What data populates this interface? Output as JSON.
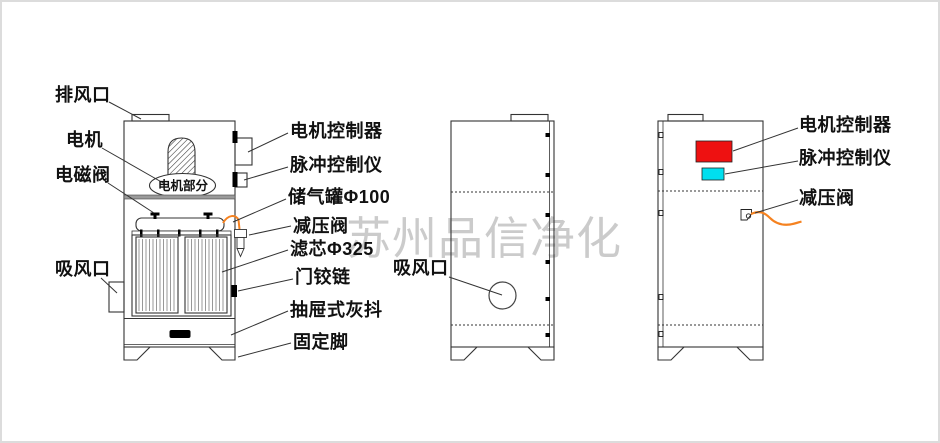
{
  "watermark": {
    "text": "苏州品信净化"
  },
  "colors": {
    "controller_red": "#ee1111",
    "pulse_cyan": "#00dfef",
    "tube_orange": "#f58220"
  },
  "front_view": {
    "motor_section_label": "电机部分",
    "labels_left": [
      {
        "id": "exhaust-outlet",
        "text": "排风口"
      },
      {
        "id": "motor",
        "text": "电机"
      },
      {
        "id": "solenoid-valve",
        "text": "电磁阀"
      },
      {
        "id": "suction-inlet",
        "text": "吸风口"
      }
    ],
    "labels_right": [
      {
        "id": "motor-controller",
        "text": "电机控制器"
      },
      {
        "id": "pulse-controller",
        "text": "脉冲控制仪"
      },
      {
        "id": "air-tank",
        "text": "储气罐Φ100"
      },
      {
        "id": "pressure-reducing-valve",
        "text": "减压阀"
      },
      {
        "id": "filter-cartridge",
        "text": "滤芯Φ325"
      },
      {
        "id": "door-hinge",
        "text": "门铰链"
      },
      {
        "id": "drawer-ash-tray",
        "text": "抽屉式灰抖"
      },
      {
        "id": "fixed-foot",
        "text": "固定脚"
      }
    ]
  },
  "side_view": {
    "labels": [
      {
        "id": "suction-inlet",
        "text": "吸风口"
      }
    ]
  },
  "back_view": {
    "labels": [
      {
        "id": "motor-controller",
        "text": "电机控制器"
      },
      {
        "id": "pulse-controller",
        "text": "脉冲控制仪"
      },
      {
        "id": "pressure-reducing-valve",
        "text": "减压阀"
      }
    ]
  }
}
